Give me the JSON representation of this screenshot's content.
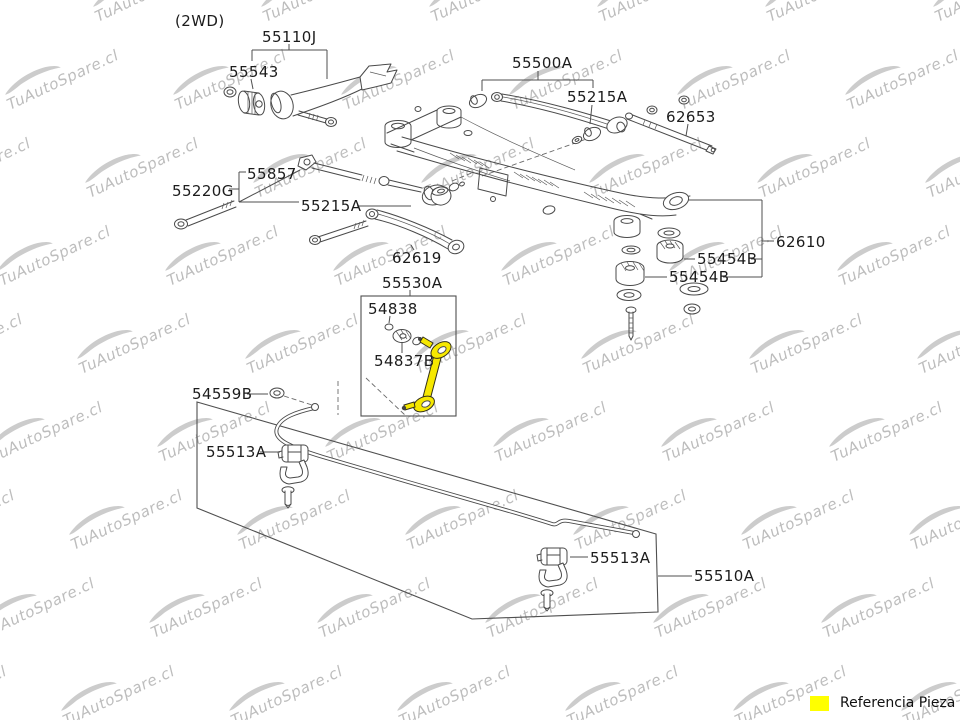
{
  "page": {
    "background": "#ffffff"
  },
  "diagram": {
    "variant_label": "(2WD)",
    "watermark": {
      "text": "TuAutoSpare.cl",
      "color": "#bdbdbd",
      "swoosh_color": "#cccccc"
    },
    "line_color": "#4a4a4a",
    "label_color": "#1c1c1c",
    "highlight_color": "#f6e800",
    "labels": [
      {
        "part": "55110J",
        "text": "55110J"
      },
      {
        "part": "55543",
        "text": "55543"
      },
      {
        "part": "55500A",
        "text": "55500A"
      },
      {
        "part": "55215A-upper",
        "text": "55215A"
      },
      {
        "part": "62653",
        "text": "62653"
      },
      {
        "part": "55857",
        "text": "55857"
      },
      {
        "part": "55220G",
        "text": "55220G"
      },
      {
        "part": "55215A-mid",
        "text": "55215A"
      },
      {
        "part": "62619",
        "text": "62619"
      },
      {
        "part": "55530A",
        "text": "55530A"
      },
      {
        "part": "54838",
        "text": "54838"
      },
      {
        "part": "54837B",
        "text": "54837B"
      },
      {
        "part": "62610",
        "text": "62610"
      },
      {
        "part": "55454B-upper",
        "text": "55454B"
      },
      {
        "part": "55454B-lower",
        "text": "55454B"
      },
      {
        "part": "54559B",
        "text": "54559B"
      },
      {
        "part": "55513A-left",
        "text": "55513A"
      },
      {
        "part": "55513A-right",
        "text": "55513A"
      },
      {
        "part": "55510A",
        "text": "55510A"
      }
    ],
    "legend": {
      "swatch_color": "#ffff00",
      "label": "Referencia Pieza"
    }
  }
}
